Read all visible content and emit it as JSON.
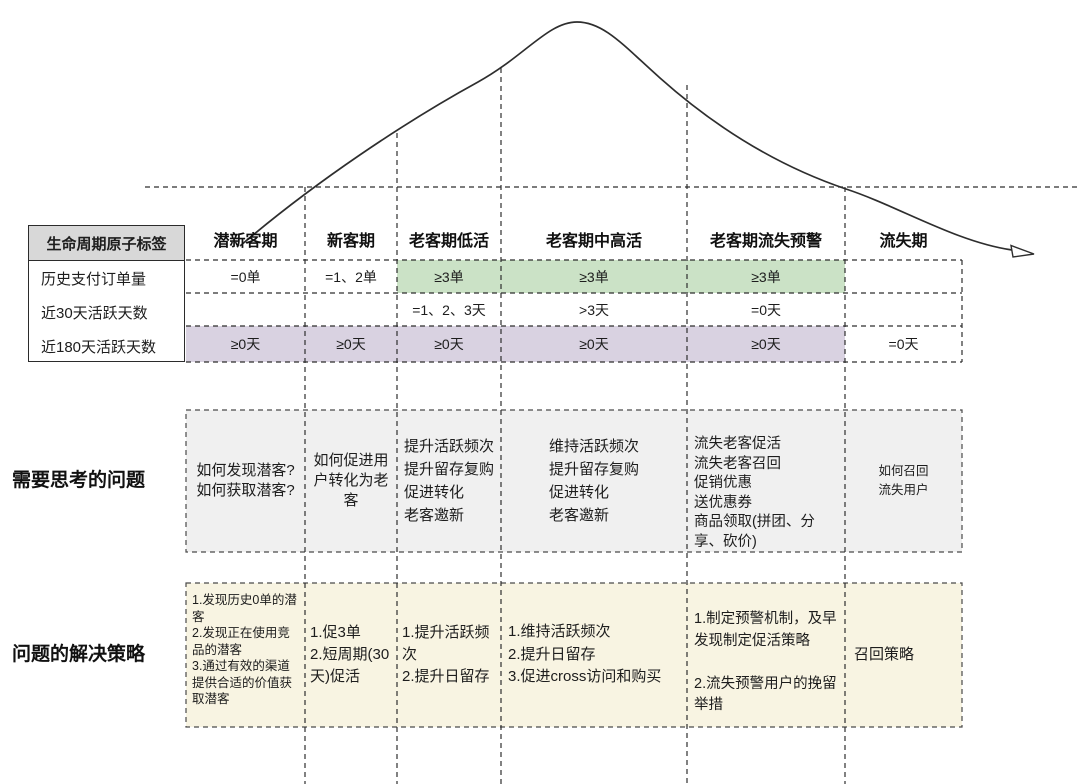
{
  "corner": {
    "title": "生命周期原子标签",
    "rows": [
      "历史支付订单量",
      "近30天活跃天数",
      "近180天活跃天数"
    ]
  },
  "sections": {
    "think": "需要思考的问题",
    "strategy": "问题的解决策略"
  },
  "columns": [
    {
      "label": "潜新客期",
      "orders": "=0单",
      "days30": "",
      "days180": "≥0天",
      "think": "如何发现潜客?\n如何获取潜客?",
      "strategy": "1.发现历史0单的潜客\n2.发现正在使用竞品的潜客\n3.通过有效的渠道提供合适的价值获取潜客"
    },
    {
      "label": "新客期",
      "orders": "=1、2单",
      "days30": "",
      "days180": "≥0天",
      "think": "如何促进用户转化为老客",
      "strategy": "1.促3单\n2.短周期(30天)促活"
    },
    {
      "label": "老客期低活",
      "orders": "≥3单",
      "days30": "=1、2、3天",
      "days180": "≥0天",
      "think": "提升活跃频次\n提升留存复购\n促进转化\n老客邀新",
      "strategy": "1.提升活跃频次\n2.提升日留存"
    },
    {
      "label": "老客期中高活",
      "orders": "≥3单",
      "days30": ">3天",
      "days180": "≥0天",
      "think": "维持活跃频次\n提升留存复购\n促进转化\n老客邀新",
      "strategy": "1.维持活跃频次\n2.提升日留存\n3.促进cross访问和购买"
    },
    {
      "label": "老客期流失预警",
      "orders": "≥3单",
      "days30": "=0天",
      "days180": "≥0天",
      "think": "流失老客促活\n流失老客召回\n促销优惠\n送优惠券\n商品领取(拼团、分享、砍价)",
      "strategy": "1.制定预警机制，及早发现制定促活策略\n\n2.流失预警用户的挽留举措"
    },
    {
      "label": "流失期",
      "orders": "",
      "days30": "",
      "days180": "=0天",
      "think": "如何召回\n流失用户",
      "strategy": "召回策略"
    }
  ],
  "colors": {
    "green_band": "#cbe2c6",
    "purple_band": "#d9d2e1",
    "questions_bg": "#f0f0f0",
    "strategy_bg": "#f8f4e2",
    "corner_header_bg": "#d8d8d8",
    "line": "#2e2e2e"
  }
}
